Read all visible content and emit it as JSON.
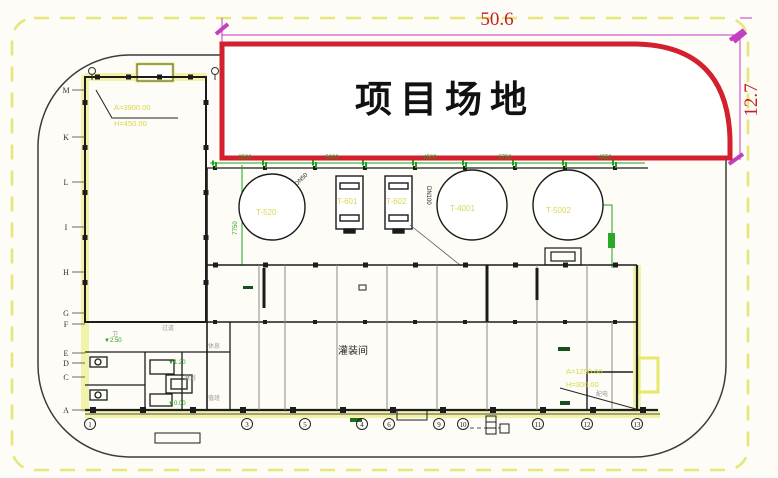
{
  "drawing": {
    "site_label": "项目场地",
    "dim_width": "50.6",
    "dim_height": "12.7",
    "colors": {
      "site_outline": "#d2202f",
      "dimension": "#c837c8",
      "boundary_dash": "#e6e67a",
      "annotation_green": "#1ea31e",
      "highlight_yellow": "#f2f2a8"
    }
  },
  "tanks": {
    "t1": "T-520",
    "t2": "T-601",
    "t3": "T-602",
    "t4": "T-4001",
    "t5": "T-5002"
  },
  "pipe_tags": {
    "tag1": "DN50",
    "tag2": "DN100"
  },
  "green_dims": {
    "d1": "2500",
    "d2": "5000",
    "d3": "4500",
    "d4": "5750",
    "d5": "4550",
    "v1": "7750"
  },
  "rooms": {
    "main": "灌装间",
    "r1": "过道",
    "r2": "卫",
    "r3": "淋浴",
    "r4": "休息",
    "r5": "值班",
    "r6": "配电"
  },
  "elevations": {
    "e1": "▼2.50",
    "e2": "▼1.20",
    "e3": "▼0.00"
  },
  "callouts": {
    "tl1": "A=3900.00",
    "tl2": "H=450.00",
    "br1": "A=1250.00",
    "br2": "H=300.00"
  },
  "axes": {
    "left": [
      "M",
      "K",
      "L",
      "I",
      "H",
      "G",
      "F",
      "E",
      "D",
      "C",
      "A"
    ],
    "bottom": [
      "1",
      "3",
      "5",
      "4",
      "6",
      "9",
      "10",
      "11",
      "12",
      "13"
    ]
  }
}
